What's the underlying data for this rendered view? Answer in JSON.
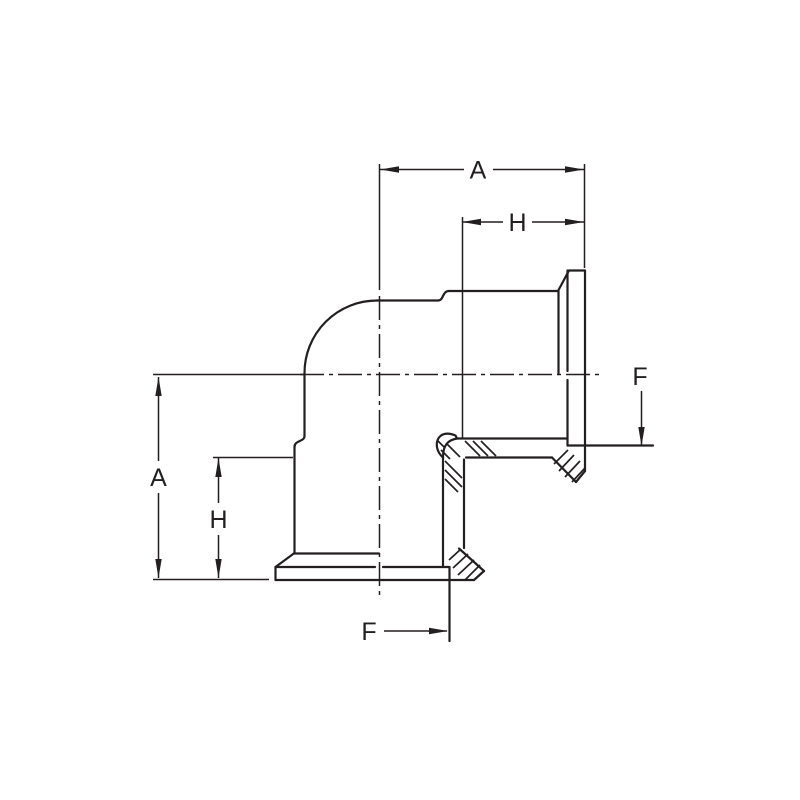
{
  "drawing": {
    "kind": "technical-dimension-drawing",
    "subject": "90-degree-elbow-clamp-fitting",
    "background_color": "#ffffff",
    "line_color": "#231f20",
    "labels": {
      "dim_a_top": "A",
      "dim_h_top": "H",
      "dim_a_left": "A",
      "dim_h_left": "H",
      "dim_f_right": "F",
      "dim_f_bottom": "F"
    }
  }
}
